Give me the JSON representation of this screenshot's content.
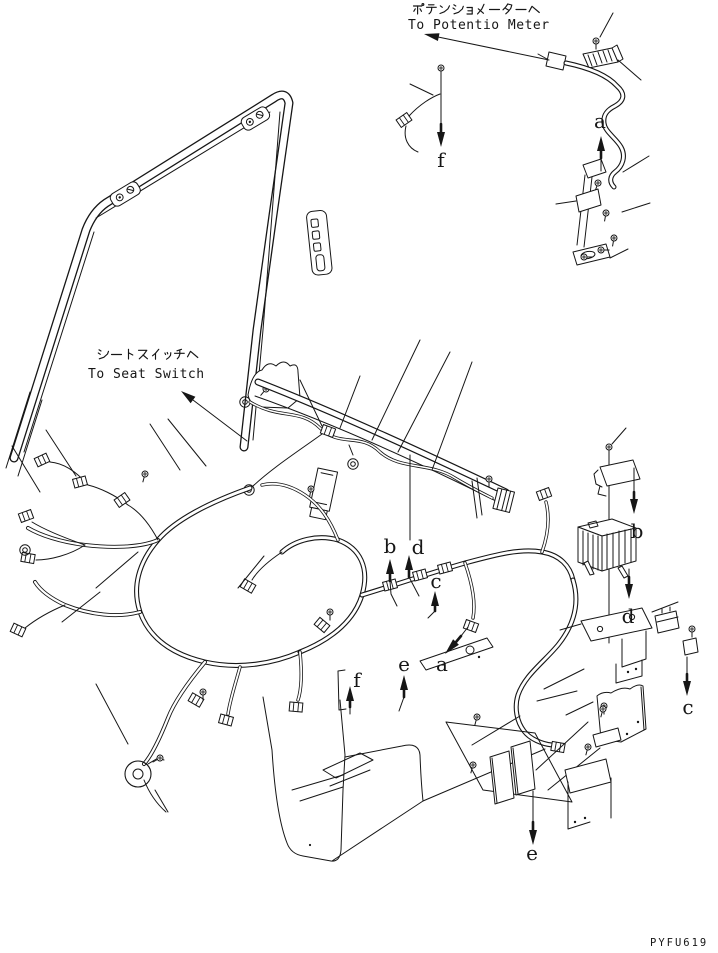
{
  "figure": {
    "part_code": "PYFU619",
    "colors": {
      "ink": "#161616",
      "paper": "#ffffff"
    },
    "annotations": {
      "potentio_jp": "ポテンショメーターヘ",
      "potentio_en": "To Potentio Meter",
      "seat_jp": "シートスイッチヘ",
      "seat_en": "To Seat Switch"
    },
    "callouts": [
      {
        "letter": "f"
      },
      {
        "letter": "a"
      },
      {
        "letter": "b"
      },
      {
        "letter": "d"
      },
      {
        "letter": "c"
      },
      {
        "letter": "e"
      },
      {
        "letter": "a"
      },
      {
        "letter": "f"
      },
      {
        "letter": "b"
      },
      {
        "letter": "d"
      },
      {
        "letter": "c"
      },
      {
        "letter": "e"
      }
    ]
  }
}
